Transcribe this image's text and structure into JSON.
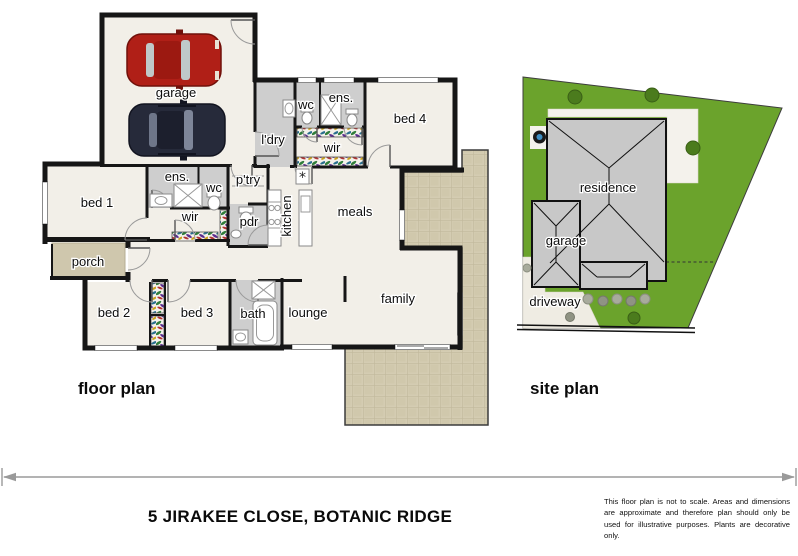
{
  "title": "5 JIRAKEE CLOSE, BOTANIC RIDGE",
  "disclaimer": "This floor plan is not to scale. Areas and dimensions are approximate and therefore plan should only be used for illustrative purposes. Plants are decorative only.",
  "floor_plan": {
    "caption": "floor plan",
    "rooms": {
      "garage": "garage",
      "bed1": "bed 1",
      "bed2": "bed 2",
      "bed3": "bed 3",
      "bed4": "bed 4",
      "ens1": "ens.",
      "ens2": "ens.",
      "wc1": "wc",
      "wc2": "wc",
      "wir1": "wir",
      "wir2": "wir",
      "ldry": "l'dry",
      "ptry": "p'try",
      "pdr": "pdr",
      "kitchen": "kitchen",
      "meals": "meals",
      "family": "family",
      "lounge": "lounge",
      "bath": "bath",
      "porch": "porch"
    },
    "symbols": {
      "hot_water": "*"
    }
  },
  "site_plan": {
    "caption": "site plan",
    "labels": {
      "residence": "residence",
      "garage": "garage",
      "driveway": "driveway"
    }
  },
  "colors": {
    "wall": "#161616",
    "floor": "#f2efe8",
    "wet_area": "#cecece",
    "paving": "#d4ccb2",
    "grass": "#6ba32c",
    "roof": "#c8c8c8",
    "car_red": "#b01f17",
    "car_navy": "#262a3a",
    "arrow": "#9a9a9a"
  }
}
